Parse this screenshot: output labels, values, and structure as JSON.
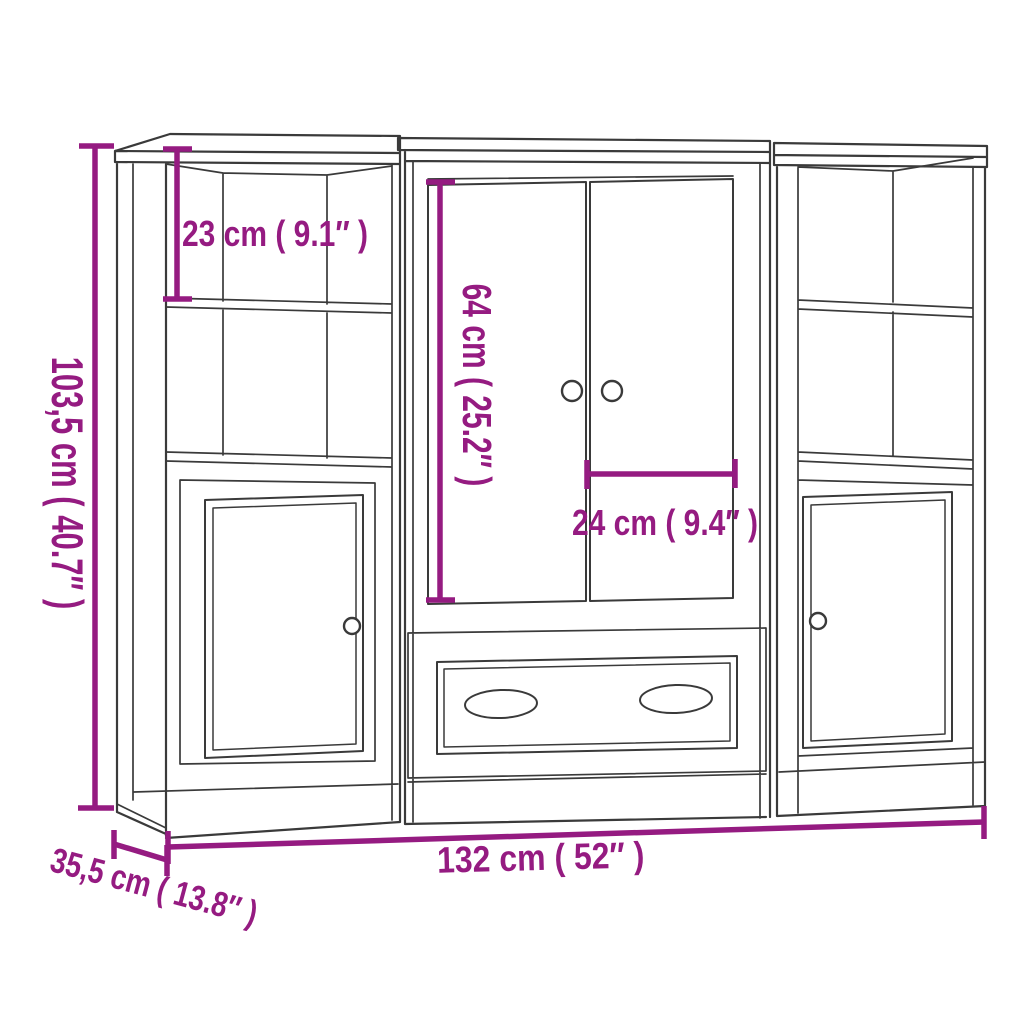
{
  "diagram": {
    "kind": "furniture-dimension-line-drawing",
    "modules": [
      "left shelf cabinet with door",
      "middle double-door cabinet with drawer",
      "right shelf cabinet with door"
    ]
  },
  "dimension_labels": {
    "height": "103,5 cm ( 40.7″ )",
    "top_compartment_height": "23 cm ( 9.1″ )",
    "door_height": "64 cm ( 25.2″ )",
    "door_width": "24 cm ( 9.4″ )",
    "width": "132 cm ( 52″  )",
    "depth": "35,5 cm ( 13.8″ )"
  },
  "dimension_values": {
    "height_cm": "103,5",
    "height_in": "40.7",
    "top_compartment_cm": "23",
    "top_compartment_in": "9.1",
    "door_height_cm": "64",
    "door_height_in": "25.2",
    "door_width_cm": "24",
    "door_width_in": "9.4",
    "width_cm": "132",
    "width_in": "52",
    "depth_cm": "35,5",
    "depth_in": "13.8"
  },
  "colors": {
    "dimension_accent": "#951b81",
    "drawing_line": "#3a3a3a",
    "background": "#ffffff"
  }
}
